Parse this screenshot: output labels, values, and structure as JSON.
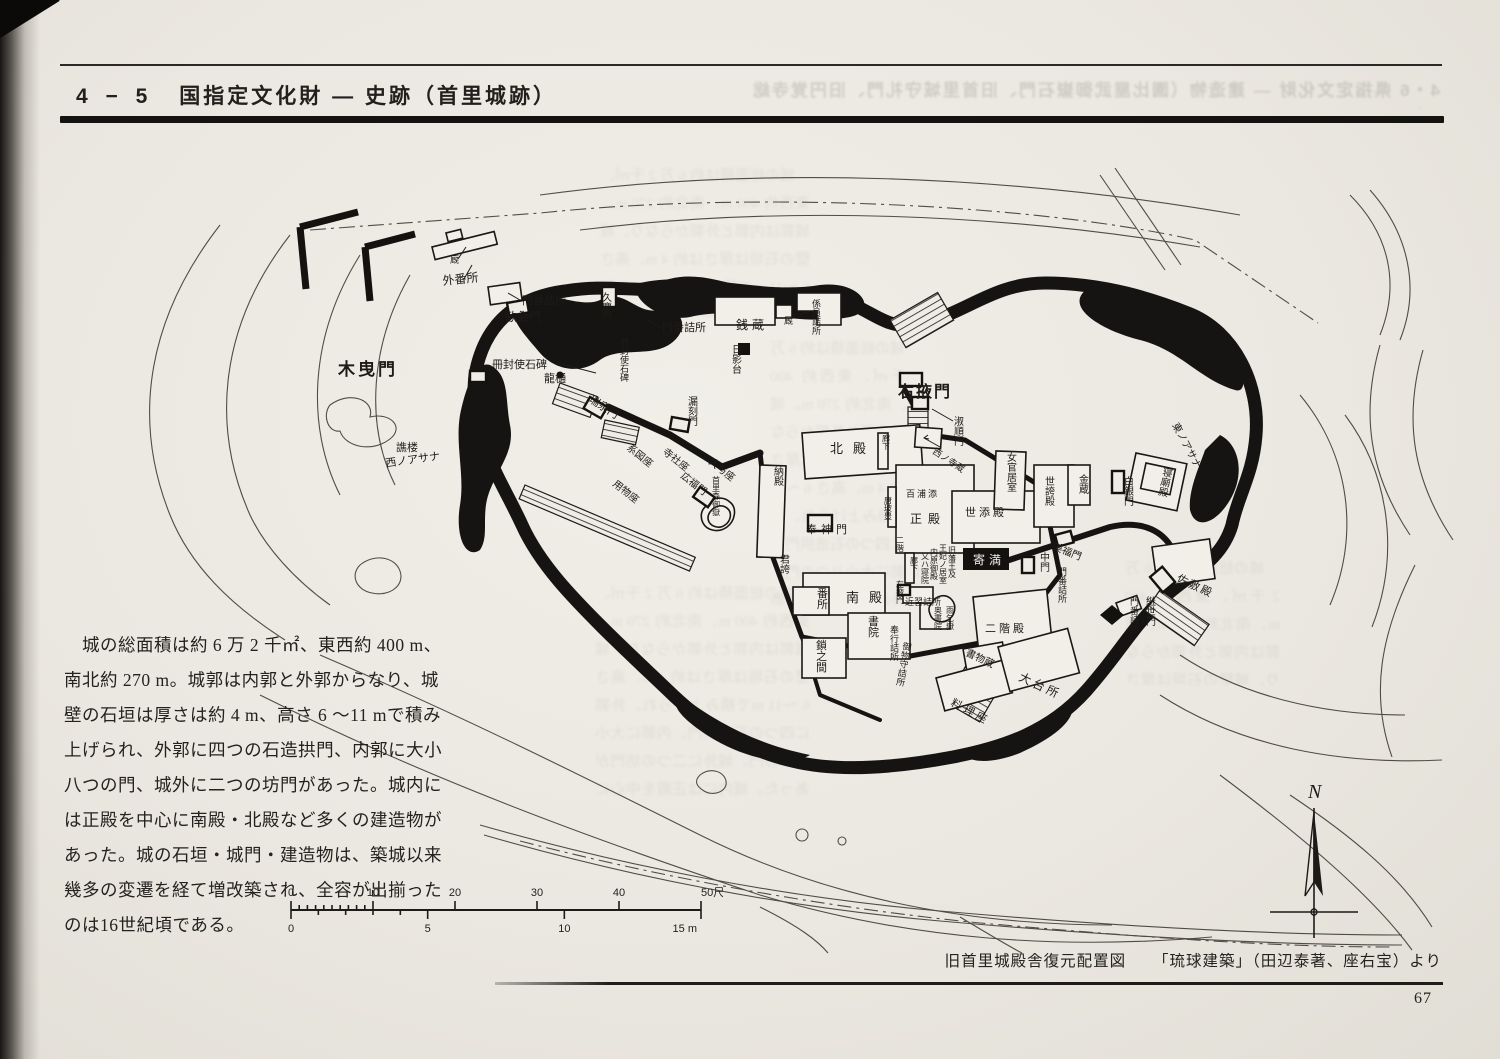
{
  "page": {
    "paper_color": "#ebe8e1",
    "ink_color": "#1c1a17"
  },
  "header": {
    "section": "4 − 5",
    "title": "国指定文化財 ― 史跡（首里城跡）"
  },
  "bleedthrough": {
    "header": "4・6 県指定文化財 ― 建造物（園比屋武御嶽石門、旧首里城守礼門、旧円覚寺総門）"
  },
  "description": {
    "lines": [
      "　城の総面積は約 6 万 2 千㎡、東西約 400 m、",
      "南北約 270 m。城郭は内郭と外郭からなり、城",
      "壁の石垣は厚さは約 4 m、高さ 6 〜11 mで積み",
      "上げられ、外郭に四つの石造拱門、内郭に大小",
      "八つの門、城外に二つの坊門があった。城内に",
      "は正殿を中心に南殿・北殿など多くの建造物が",
      "あった。城の石垣・城門・建造物は、築城以来",
      "幾多の変遷を経て増改築され、全容が出揃った",
      "のは16世紀頃である。"
    ]
  },
  "map": {
    "compass_label": "N",
    "scale": {
      "shaku_ticks": [
        "0",
        "10",
        "20",
        "30",
        "40",
        "50尺"
      ],
      "m_ticks": [
        "0",
        "5",
        "10",
        "15 m"
      ]
    },
    "labels": [
      {
        "t": "厩",
        "x": 390,
        "y": 128,
        "s": 9,
        "o": "h"
      },
      {
        "t": "外番所",
        "x": 383,
        "y": 150,
        "s": 12,
        "o": "h",
        "r": -6
      },
      {
        "t": "門番詰所",
        "x": 462,
        "y": 169,
        "s": 11,
        "o": "h"
      },
      {
        "t": "歓会門",
        "x": 445,
        "y": 186,
        "s": 12,
        "o": "h"
      },
      {
        "t": "久慶門",
        "x": 542,
        "y": 166,
        "s": 10,
        "o": "v"
      },
      {
        "t": "門番詰所",
        "x": 602,
        "y": 196,
        "s": 11,
        "o": "h"
      },
      {
        "t": "銭蔵",
        "x": 676,
        "y": 194,
        "s": 12,
        "o": "h",
        "ls": 4
      },
      {
        "t": "厩",
        "x": 724,
        "y": 189,
        "s": 9,
        "o": "h"
      },
      {
        "t": "係員詰所",
        "x": 752,
        "y": 172,
        "s": 9,
        "o": "v"
      },
      {
        "t": "木曳門",
        "x": 278,
        "y": 240,
        "s": 17,
        "o": "h",
        "w": "bold",
        "ls": 3
      },
      {
        "t": "冊封使石碑",
        "x": 432,
        "y": 233,
        "s": 11,
        "o": "h"
      },
      {
        "t": "龍樋",
        "x": 484,
        "y": 247,
        "s": 11,
        "o": "h"
      },
      {
        "t": "冊封使石碑",
        "x": 560,
        "y": 210,
        "s": 9,
        "o": "v"
      },
      {
        "t": "瑞泉門",
        "x": 528,
        "y": 266,
        "s": 11,
        "o": "h",
        "r": 33
      },
      {
        "t": "漏刻門",
        "x": 628,
        "y": 270,
        "s": 10,
        "o": "v"
      },
      {
        "t": "日影台",
        "x": 672,
        "y": 218,
        "s": 10,
        "o": "v"
      },
      {
        "t": "右掖門",
        "x": 838,
        "y": 262,
        "s": 16,
        "o": "h",
        "w": "bold",
        "ls": 2
      },
      {
        "t": "譙楼",
        "x": 336,
        "y": 316,
        "s": 11,
        "o": "h"
      },
      {
        "t": "西ノアサナ",
        "x": 326,
        "y": 332,
        "s": 11,
        "o": "h",
        "r": -8
      },
      {
        "t": "系図座",
        "x": 566,
        "y": 314,
        "s": 10,
        "o": "h",
        "r": 38
      },
      {
        "t": "用物座",
        "x": 552,
        "y": 350,
        "s": 10,
        "o": "h",
        "r": 38
      },
      {
        "t": "寺社座",
        "x": 602,
        "y": 318,
        "s": 10,
        "o": "h",
        "r": 38
      },
      {
        "t": "広福門",
        "x": 620,
        "y": 342,
        "s": 10,
        "o": "h",
        "r": 38
      },
      {
        "t": "大与座",
        "x": 648,
        "y": 328,
        "s": 10,
        "o": "h",
        "r": 38
      },
      {
        "t": "首里森御嶽",
        "x": 652,
        "y": 348,
        "s": 8,
        "o": "v"
      },
      {
        "t": "納殿",
        "x": 714,
        "y": 340,
        "s": 10,
        "o": "v"
      },
      {
        "t": "北殿",
        "x": 770,
        "y": 318,
        "s": 13,
        "o": "h",
        "ls": 10
      },
      {
        "t": "奉神門",
        "x": 746,
        "y": 398,
        "s": 11,
        "o": "h",
        "ls": 4
      },
      {
        "t": "君誇",
        "x": 720,
        "y": 428,
        "s": 10,
        "o": "v"
      },
      {
        "t": "淑順門",
        "x": 894,
        "y": 290,
        "s": 10,
        "o": "v"
      },
      {
        "t": "西ノ寺蔵",
        "x": 872,
        "y": 318,
        "s": 9,
        "o": "h",
        "r": 33
      },
      {
        "t": "女官居室",
        "x": 947,
        "y": 326,
        "s": 10,
        "o": "v"
      },
      {
        "t": "世誇殿",
        "x": 985,
        "y": 350,
        "s": 10,
        "o": "v"
      },
      {
        "t": "金蔵",
        "x": 1019,
        "y": 348,
        "s": 10,
        "o": "v"
      },
      {
        "t": "白銀門",
        "x": 1064,
        "y": 350,
        "s": 10,
        "o": "v"
      },
      {
        "t": "寝廟殿",
        "x": 1102,
        "y": 340,
        "s": 10,
        "o": "v",
        "r": 12
      },
      {
        "t": "東ノアサナ",
        "x": 1112,
        "y": 290,
        "s": 10,
        "o": "h",
        "r": 62
      },
      {
        "t": "百浦添",
        "x": 846,
        "y": 362,
        "s": 9,
        "o": "h",
        "ls": 2
      },
      {
        "t": "正殿",
        "x": 850,
        "y": 388,
        "s": 12,
        "o": "h",
        "ls": 6
      },
      {
        "t": "唐玻豊",
        "x": 824,
        "y": 368,
        "s": 8,
        "o": "v"
      },
      {
        "t": "二階",
        "x": 836,
        "y": 408,
        "s": 8,
        "o": "v"
      },
      {
        "t": "廊下",
        "x": 822,
        "y": 306,
        "s": 8,
        "o": "v"
      },
      {
        "t": "廊下",
        "x": 850,
        "y": 428,
        "s": 8,
        "o": "v"
      },
      {
        "t": "世添殿",
        "x": 905,
        "y": 381,
        "s": 11,
        "o": "h",
        "ls": 3
      },
      {
        "t": "寄満",
        "x": 913,
        "y": 429,
        "s": 12,
        "o": "h",
        "ls": 4,
        "inv": true
      },
      {
        "t": "中門",
        "x": 980,
        "y": 426,
        "s": 10,
        "o": "v"
      },
      {
        "t": "門番詰所",
        "x": 998,
        "y": 440,
        "s": 9,
        "o": "v"
      },
      {
        "t": "左掖門",
        "x": 836,
        "y": 452,
        "s": 8,
        "o": "v"
      },
      {
        "t": "近習詰所",
        "x": 845,
        "y": 470,
        "s": 9,
        "o": "h"
      },
      {
        "t": "旧藩王及",
        "x": 888,
        "y": 418,
        "s": 8,
        "o": "v"
      },
      {
        "t": "王妃ノ居室",
        "x": 879,
        "y": 416,
        "s": 8,
        "o": "v"
      },
      {
        "t": "内原御殿",
        "x": 870,
        "y": 420,
        "s": 8,
        "o": "v"
      },
      {
        "t": "又ハ寝院",
        "x": 861,
        "y": 424,
        "s": 8,
        "o": "v"
      },
      {
        "t": "番所",
        "x": 757,
        "y": 462,
        "s": 11,
        "o": "v"
      },
      {
        "t": "南殿",
        "x": 786,
        "y": 467,
        "s": 13,
        "o": "h",
        "ls": 10
      },
      {
        "t": "書院",
        "x": 808,
        "y": 490,
        "s": 11,
        "o": "v"
      },
      {
        "t": "奉行詰所",
        "x": 830,
        "y": 498,
        "s": 9,
        "o": "v"
      },
      {
        "t": "奥書院",
        "x": 874,
        "y": 478,
        "s": 8,
        "o": "v"
      },
      {
        "t": "御物守詰所",
        "x": 842,
        "y": 514,
        "s": 9,
        "o": "v",
        "r": 10
      },
      {
        "t": "鎖之間",
        "x": 756,
        "y": 514,
        "s": 11,
        "o": "v"
      },
      {
        "t": "二階殿",
        "x": 925,
        "y": 497,
        "s": 11,
        "o": "h",
        "ls": 3
      },
      {
        "t": "書物蔵",
        "x": 905,
        "y": 520,
        "s": 10,
        "o": "h",
        "r": 25
      },
      {
        "t": "雨乞嶽",
        "x": 886,
        "y": 478,
        "s": 8,
        "o": "v"
      },
      {
        "t": "料理座",
        "x": 890,
        "y": 570,
        "s": 11,
        "o": "h",
        "r": 28,
        "ls": 3
      },
      {
        "t": "大台所",
        "x": 958,
        "y": 545,
        "s": 12,
        "o": "h",
        "r": 25,
        "ls": 3
      },
      {
        "t": "門番詰所",
        "x": 1070,
        "y": 470,
        "s": 9,
        "o": "v"
      },
      {
        "t": "継世門",
        "x": 1086,
        "y": 470,
        "s": 10,
        "o": "v"
      },
      {
        "t": "佐敷殿",
        "x": 1116,
        "y": 446,
        "s": 11,
        "o": "h",
        "r": 25,
        "ls": 2
      },
      {
        "t": "美福門",
        "x": 992,
        "y": 414,
        "s": 10,
        "o": "h",
        "r": 22
      }
    ]
  },
  "caption": {
    "title": "旧首里城殿舎復元配置図",
    "source": "「琉球建築」（田辺泰著、座右宝）より"
  },
  "page_number": "67"
}
